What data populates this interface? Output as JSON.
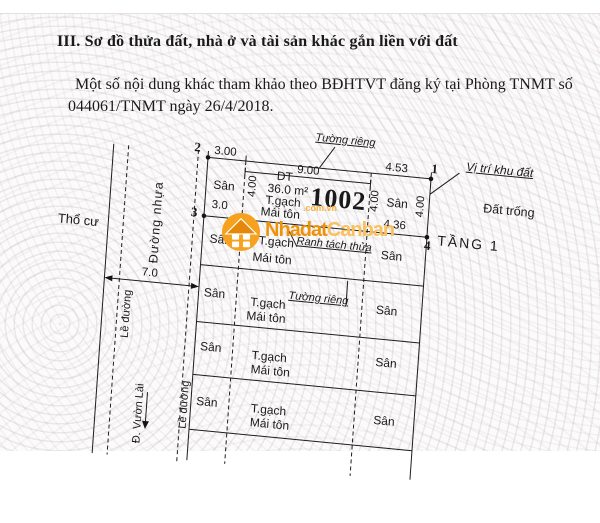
{
  "header": {
    "section_title": "III. Sơ đồ thửa đất, nhà ở và tài sản khác gắn liền với đất",
    "note_line1": "Một số nội dung khác tham khảo theo BĐHTVT đăng ký tại Phòng TNMT số",
    "note_line2": "044061/TNMT ngày 26/4/2018."
  },
  "diagram": {
    "parcel": {
      "number": "1002",
      "area_prefix": "DT",
      "area": "36.0 m²",
      "floor": "TẦNG 1"
    },
    "points": {
      "p1": "1",
      "p2": "2",
      "p3": "3",
      "p4": "4"
    },
    "dims": {
      "top_left": "3.00",
      "top_mid": "9.00",
      "top_right": "4.53",
      "left_mid": "3.0",
      "mid_right": "4.36",
      "depth": "4.00",
      "road_width": "7.0"
    },
    "labels": {
      "yard": "Sân",
      "brick_wall": "T.gạch",
      "metal_roof": "Mái tôn",
      "private_wall": "Tường riêng",
      "split_boundary": "Ranh tách thửa",
      "site_location": "Vị trí khu đất",
      "empty_land": "Đất trống",
      "residential_land": "Thổ cư",
      "asphalt_road": "Đường nhựa",
      "road_edge": "Lề đường",
      "street_name": "Đ. Vườn Lài"
    }
  },
  "watermark": {
    "brand_part1": "Nhadat",
    "brand_part2": "Canban",
    "tld": ".com.vn"
  },
  "colors": {
    "wm-icon": "#F6A21E",
    "wm-roof": "#E5870A",
    "wm-text1": "#EF920B",
    "wm-text2": "#F9C060",
    "wm-tld": "#F7B13C",
    "line": "#1d1d1d"
  }
}
